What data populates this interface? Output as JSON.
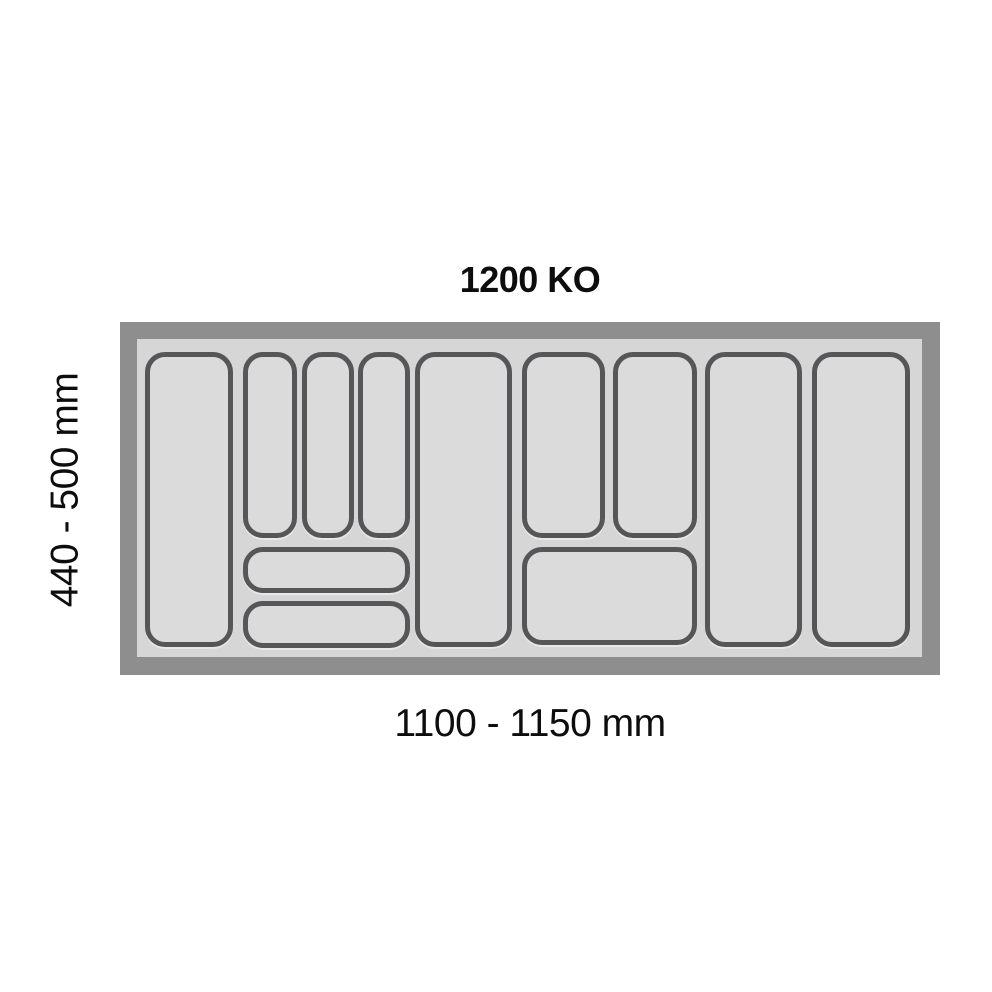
{
  "title": "1200 KO",
  "dimension_labels": {
    "vertical": "440 - 500 mm",
    "horizontal": "1100 - 1150 mm"
  },
  "colors": {
    "page-bg": "#ffffff",
    "frame": "#8e8e8e",
    "interior": "#d6d6d6",
    "compartment-fill": "#dbdbdb",
    "compartment-stroke": "#565659",
    "text": "#0d0d0d"
  },
  "tray": {
    "description": "cutlery tray insert, top view, 12 compartments",
    "compartments": [
      {
        "id": "tall-column-1",
        "x": 8,
        "y": 13,
        "w": 88,
        "h": 295
      },
      {
        "id": "narrow-slot-1",
        "x": 106,
        "y": 13,
        "w": 54,
        "h": 186
      },
      {
        "id": "narrow-slot-2",
        "x": 165,
        "y": 13,
        "w": 52,
        "h": 186
      },
      {
        "id": "narrow-slot-3",
        "x": 221,
        "y": 13,
        "w": 52,
        "h": 186
      },
      {
        "id": "left-strip-1",
        "x": 106,
        "y": 208,
        "w": 167,
        "h": 46
      },
      {
        "id": "left-strip-2",
        "x": 106,
        "y": 262,
        "w": 167,
        "h": 47
      },
      {
        "id": "tall-column-2",
        "x": 278,
        "y": 13,
        "w": 97,
        "h": 295
      },
      {
        "id": "medium-slot-1",
        "x": 385,
        "y": 13,
        "w": 83,
        "h": 186
      },
      {
        "id": "medium-slot-2",
        "x": 476,
        "y": 13,
        "w": 84,
        "h": 186
      },
      {
        "id": "wide-box",
        "x": 385,
        "y": 208,
        "w": 175,
        "h": 98
      },
      {
        "id": "tall-column-3",
        "x": 568,
        "y": 13,
        "w": 97,
        "h": 295
      },
      {
        "id": "tall-column-4",
        "x": 675,
        "y": 13,
        "w": 98,
        "h": 295
      }
    ]
  }
}
